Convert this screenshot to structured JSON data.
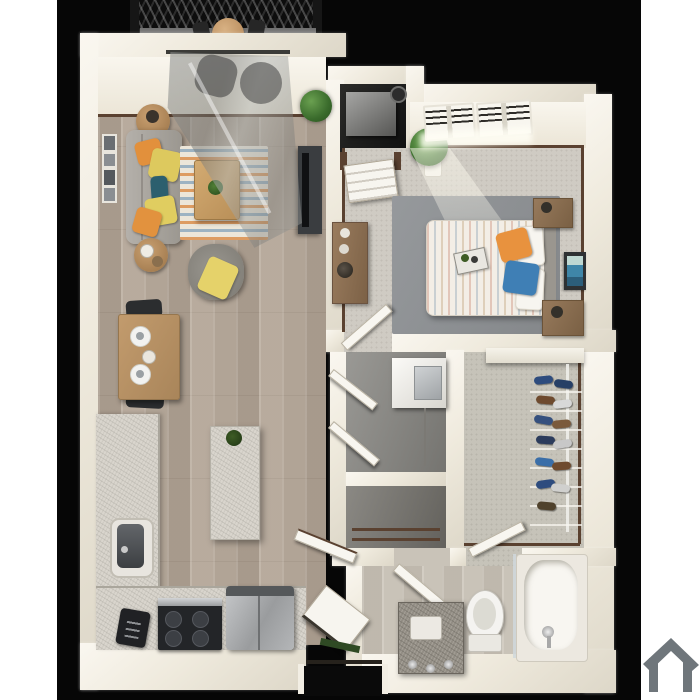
{
  "scene": {
    "title": "3D one-bedroom apartment floor plan render",
    "background": {
      "page_color": "#ffffff",
      "photo_color": "#060606"
    },
    "watermark": {
      "name": "home-logo",
      "color": "#6f767b"
    },
    "palette": {
      "wall": "#f1ede3",
      "wall_shade": "#ddd7c8",
      "baseboard_trim": "#5a4130",
      "wood_floor": "#b3a698",
      "carpet": "#cfcbc3",
      "closet_carpet": "#c6c3b9",
      "bath_floor": "#c9c3b8",
      "bedroom_rug": "#8c8f92",
      "granite": "#d9d5cd",
      "vanity_granite": "#938e85",
      "sofa_gray": "#a6a29b",
      "armchair_gray": "#8f8c86",
      "accent_orange": "#e2903c",
      "accent_yellow": "#e0cd60",
      "accent_teal": "#2c5f6e",
      "accent_blue": "#3f7fb5",
      "plant_green": "#4a8040",
      "table_wood": "#b5926a",
      "appliance_black": "#202124",
      "stainless_steel": "#a8abad",
      "balcony_railing": "#0d0d0d",
      "glass_reflection": "#9a9c9a"
    },
    "rooms": [
      {
        "id": "balcony",
        "label": "Balcony",
        "contents": [
          "black lattice railing",
          "round bistro table",
          "two dark patio chairs"
        ]
      },
      {
        "id": "living-room",
        "label": "Living Room",
        "contents": [
          "gray sofa with orange, yellow and teal pillows",
          "two round wood side tables",
          "chevron area rug",
          "wood coffee table with plant",
          "gray armchair with yellow throw",
          "gallery wall frames",
          "TV console",
          "sliding glass balcony door"
        ]
      },
      {
        "id": "dining-area",
        "label": "Dining Area",
        "contents": [
          "wood dining table",
          "two black chairs",
          "two place settings",
          "centerpiece"
        ]
      },
      {
        "id": "kitchen",
        "label": "Kitchen",
        "contents": [
          "L-shaped granite counter",
          "undermount sink",
          "black toaster",
          "black range",
          "stainless refrigerator",
          "granite island with green bowl"
        ]
      },
      {
        "id": "entry",
        "label": "Entry Porch",
        "contents": [
          "front door with brown frame",
          "utility alcove with water heater",
          "potted plant"
        ]
      },
      {
        "id": "bedroom",
        "label": "Bedroom",
        "contents": [
          "bed with striped duvet",
          "orange and blue accent pillows",
          "two wood nightstands",
          "dresser with decor",
          "blue wall art",
          "slatted windows",
          "potted plant",
          "dark gray area rug",
          "bedroom door"
        ]
      },
      {
        "id": "laundry-closet",
        "label": "Laundry Closet",
        "contents": [
          "stacked washer unit",
          "bifold doors"
        ]
      },
      {
        "id": "linen-closet",
        "label": "Linen Closet",
        "contents": [
          "wood shelves",
          "closet door"
        ]
      },
      {
        "id": "walk-in-closet",
        "label": "Walk-in Closet",
        "contents": [
          "white top shelf",
          "hanging rod",
          "shoe shelves with blue and brown shoes"
        ]
      },
      {
        "id": "bathroom",
        "label": "Bathroom",
        "contents": [
          "granite vanity with sink and faucets",
          "toilet",
          "bathtub with glass shower panel",
          "hall door"
        ]
      }
    ]
  }
}
